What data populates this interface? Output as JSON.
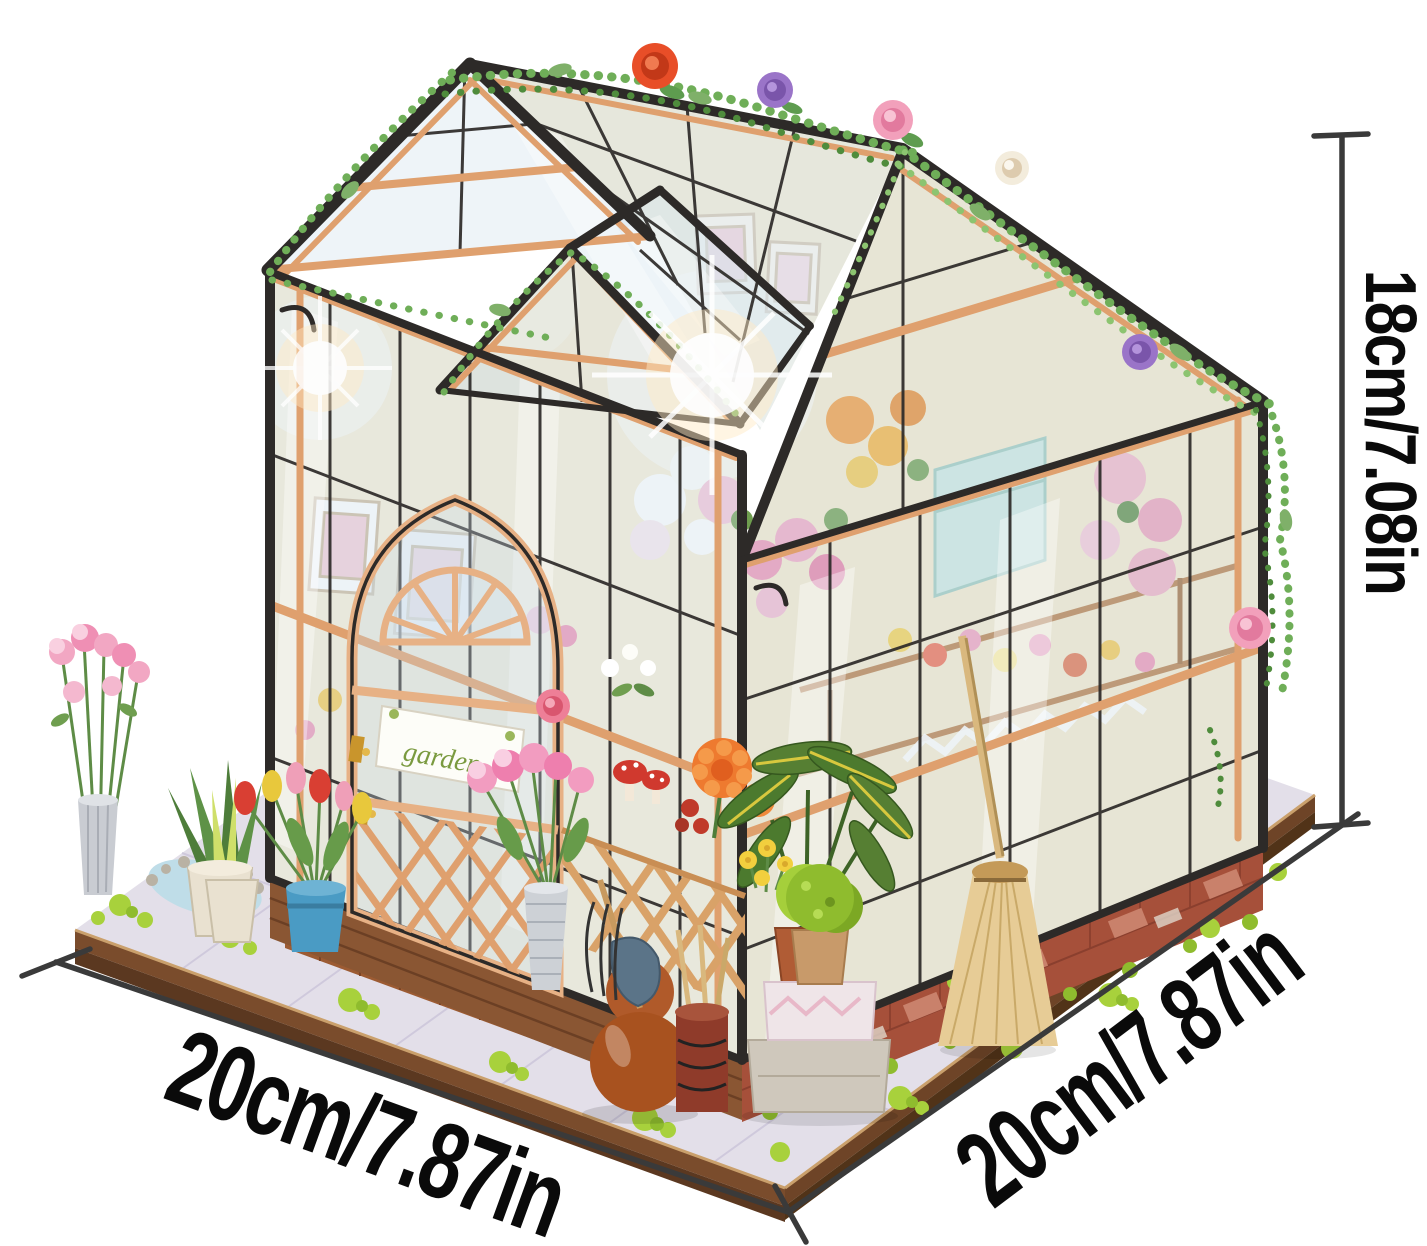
{
  "scene": {
    "subject": "DIY miniature greenhouse flower-house dollhouse kit, product photo on white background",
    "background_color": "#ffffff",
    "door_sign_text": "garden"
  },
  "dimensions": {
    "height": {
      "label": "18cm/7.08in"
    },
    "width_left": {
      "label": "20cm/7.87in"
    },
    "depth_right": {
      "label": "20cm/7.87in"
    },
    "line_color": "#3a3a3a",
    "label_color": "#0a0a0a"
  },
  "palette": {
    "frame_black": "#2d2a28",
    "wood_tan": "#dfa06e",
    "wood_dark": "#8a5a35",
    "brick": "#a6503a",
    "glass_tint": "#cbdce9",
    "ground_tile": "#e3dfe9",
    "moss_green": "#a8d13c",
    "vine_green": "#6fae58",
    "rose_orange": "#e84e28",
    "rose_pink": "#f2a0bb",
    "rose_purple": "#9a74c8",
    "rose_cream": "#f3ecdc"
  }
}
